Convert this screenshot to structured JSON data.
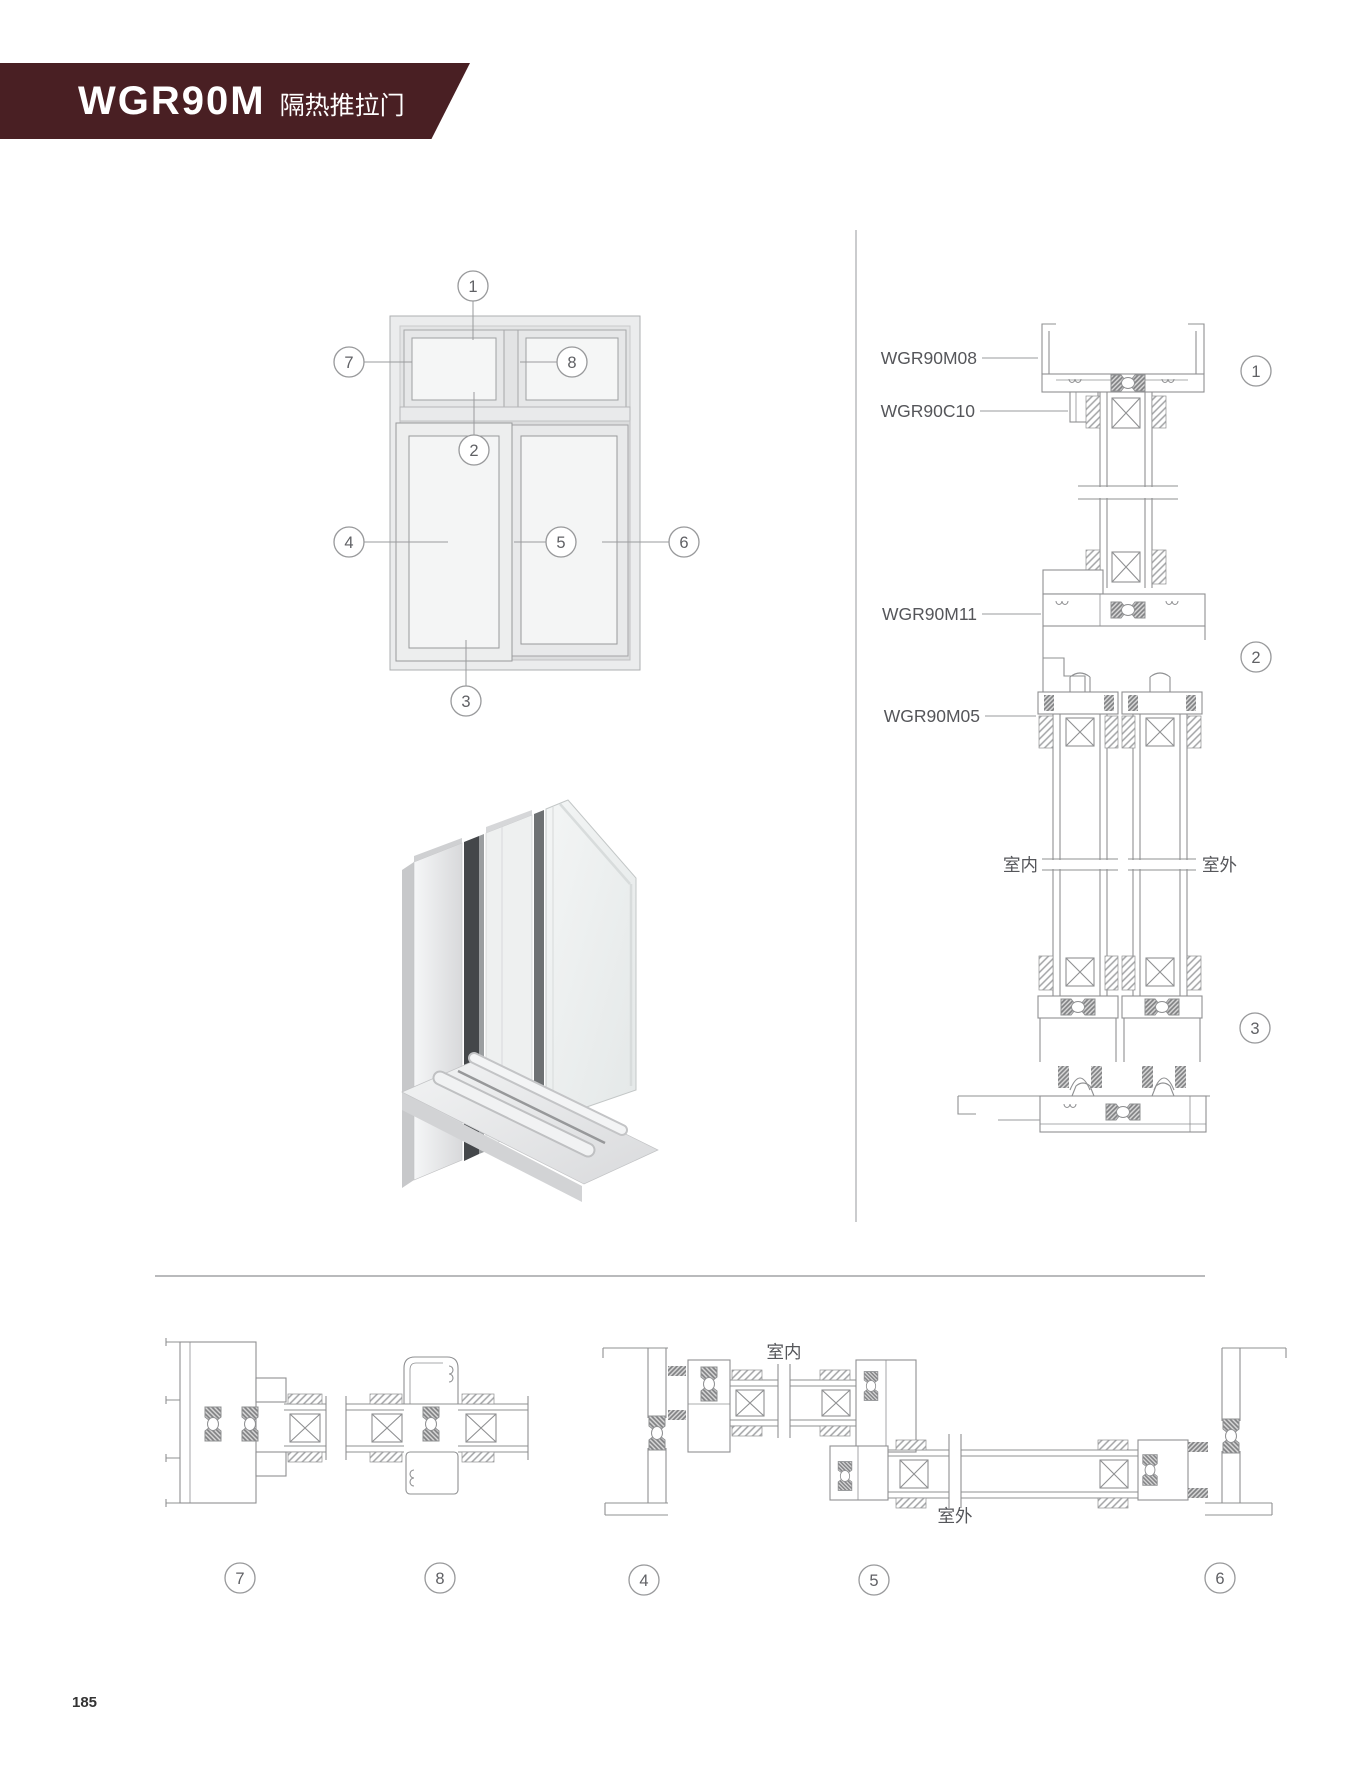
{
  "header": {
    "model": "WGR90M",
    "subtitle": "隔热推拉门",
    "banner_color": "#491f23"
  },
  "page_number": "185",
  "colors": {
    "line": "#8f9092",
    "label": "#55565a",
    "divider": "#c0c1c3"
  },
  "elevation": {
    "callouts": {
      "c1": "1",
      "c2": "2",
      "c3": "3",
      "c4": "4",
      "c5": "5",
      "c6": "6",
      "c7": "7",
      "c8": "8"
    }
  },
  "vertical_section": {
    "labels": {
      "top_frame": "WGR90M08",
      "adapter": "WGR90C10",
      "trans_rail": "WGR90M11",
      "sash_profile": "WGR90M05",
      "bottom_track": "WGR90M02",
      "indoor": "室内",
      "outdoor": "室外"
    },
    "callouts": {
      "c1": "1",
      "c2": "2",
      "c3": "3"
    }
  },
  "horizontal_sections": {
    "labels": {
      "indoor": "室内",
      "outdoor": "室外"
    },
    "callouts": {
      "c4": "4",
      "c5": "5",
      "c6": "6",
      "c7": "7",
      "c8": "8"
    }
  }
}
